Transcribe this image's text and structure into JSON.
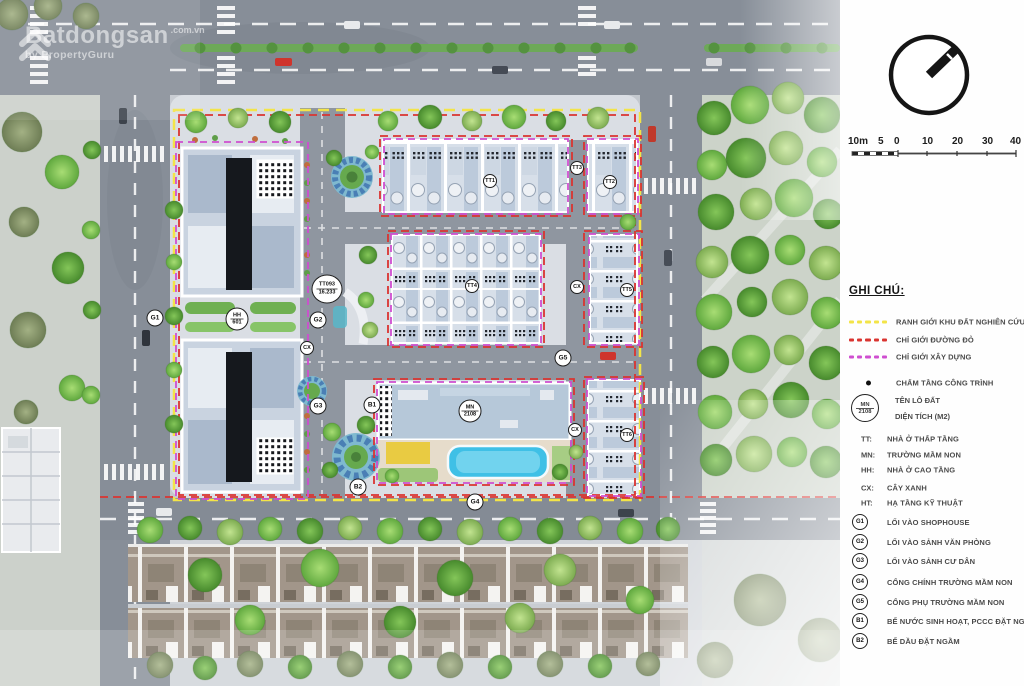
{
  "watermark": {
    "brand": "Batdongsan",
    "suffix": ".com.vn",
    "byline": "by PropertyGuru"
  },
  "scale_bar": {
    "labels": [
      "10m",
      "5",
      "0",
      "10",
      "20",
      "30",
      "40"
    ]
  },
  "legend": {
    "title": "GHI CHÚ:",
    "boundary_items": [
      {
        "label": "RANH GIỚI KHU ĐẤT NGHIÊN CỨU",
        "color": "#f3e448",
        "style": "dashed"
      },
      {
        "label": "CHỈ GIỚI ĐƯỜNG ĐỎ",
        "color": "#da3430",
        "style": "dashed"
      },
      {
        "label": "CHỈ GIỚI XÂY DỰNG",
        "color": "#cf4ed0",
        "style": "dashed"
      }
    ],
    "dot_item": {
      "label": "CHẤM TẦNG CÔNG TRÌNH",
      "color": "#111111"
    },
    "lot_sample": {
      "code": "MN",
      "area": "2108",
      "label_code": "TÊN LÔ ĐẤT",
      "label_area": "DIỆN TÍCH (M2)"
    },
    "abbreviations": [
      {
        "key": "TT:",
        "label": "NHÀ Ở THẤP TẦNG"
      },
      {
        "key": "MN:",
        "label": "TRƯỜNG MẦM NON"
      },
      {
        "key": "HH:",
        "label": "NHÀ Ở CAO TẦNG"
      },
      {
        "key": "CX:",
        "label": "CÂY XANH"
      },
      {
        "key": "HT:",
        "label": "HẠ TẦNG KỸ THUẬT"
      }
    ],
    "gates": [
      {
        "key": "G1",
        "label": "LỐI VÀO SHOPHOUSE"
      },
      {
        "key": "G2",
        "label": "LỐI VÀO SẢNH VĂN PHÒNG"
      },
      {
        "key": "G3",
        "label": "LỐI VÀO SẢNH CƯ DÂN"
      },
      {
        "key": "G4",
        "label": "CỔNG CHÍNH TRƯỜNG MẦM NON"
      },
      {
        "key": "G5",
        "label": "CỔNG PHỤ TRƯỜNG MẦM NON"
      },
      {
        "key": "B1",
        "label": "BỂ NƯỚC SINH HOẠT, PCCC ĐẶT NGẦM"
      },
      {
        "key": "B2",
        "label": "BỂ DẦU ĐẶT NGẦM"
      }
    ]
  },
  "plan": {
    "markers": {
      "g1": "G1",
      "g2": "G2",
      "g3": "G3",
      "g4": "G4",
      "g5": "G5",
      "b1": "B1",
      "b2": "B2",
      "tt1": "TT1",
      "tt2": "TT2",
      "tt3": "TT3",
      "tt4": "TT4",
      "tt5": "TT5",
      "tt6": "TT6",
      "cx_a": "CX",
      "cx_b": "CX",
      "cx_c": "CX",
      "hh": {
        "code": "HH",
        "area": "601"
      },
      "mn": {
        "code": "MN",
        "area": "2108"
      },
      "tt_lot": {
        "code": "TT093",
        "area": "16.233"
      }
    },
    "colors": {
      "road": "#878e98",
      "site_ground": "#dadee4",
      "tree_green": "#6db544",
      "pool_blue": "#3fc0e6",
      "roof_blue": "#b6c8d9",
      "house_roof_tan": "#a2968a"
    }
  }
}
